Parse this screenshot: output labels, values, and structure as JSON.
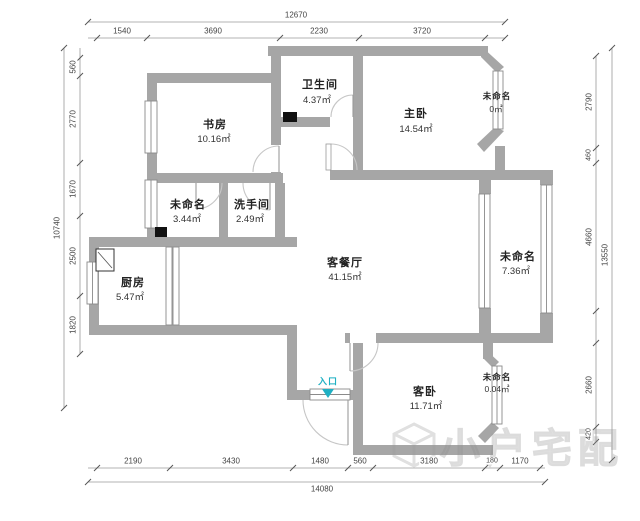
{
  "rooms": {
    "bathroom": {
      "name": "卫生间",
      "area": "4.37㎡"
    },
    "master": {
      "name": "主卧",
      "area": "14.54㎡"
    },
    "bay_top": {
      "name": "未命名",
      "area": "0㎡"
    },
    "study": {
      "name": "书房",
      "area": "10.16㎡"
    },
    "unnamed_mid": {
      "name": "未命名",
      "area": "3.44㎡"
    },
    "washroom": {
      "name": "洗手间",
      "area": "2.49㎡"
    },
    "living": {
      "name": "客餐厅",
      "area": "41.15㎡"
    },
    "balcony": {
      "name": "未命名",
      "area": "7.36㎡"
    },
    "kitchen": {
      "name": "厨房",
      "area": "5.47㎡"
    },
    "guest": {
      "name": "客卧",
      "area": "11.71㎡"
    },
    "bay_bottom": {
      "name": "未命名",
      "area": "0.04㎡"
    }
  },
  "entrance": {
    "label": "入口"
  },
  "dims": {
    "top": {
      "total": "12670",
      "segments": [
        "1540",
        "3690",
        "2230",
        "3720"
      ]
    },
    "bottom": {
      "total": "14080",
      "segments": [
        "2190",
        "3430",
        "1480",
        "560",
        "3180",
        "180",
        "1170"
      ]
    },
    "left": {
      "total": "10740",
      "segments": [
        "560",
        "2770",
        "1670",
        "2500",
        "1820"
      ]
    },
    "right": {
      "total": "13550",
      "segments": [
        "2790",
        "460",
        "4660",
        "2660",
        "420"
      ]
    }
  },
  "watermark": {
    "text": "小户宅配"
  },
  "colors": {
    "wall": "#a6a6a6",
    "entrance_accent": "#1fb0c3",
    "column": "#111111",
    "dim_text": "#444444"
  }
}
